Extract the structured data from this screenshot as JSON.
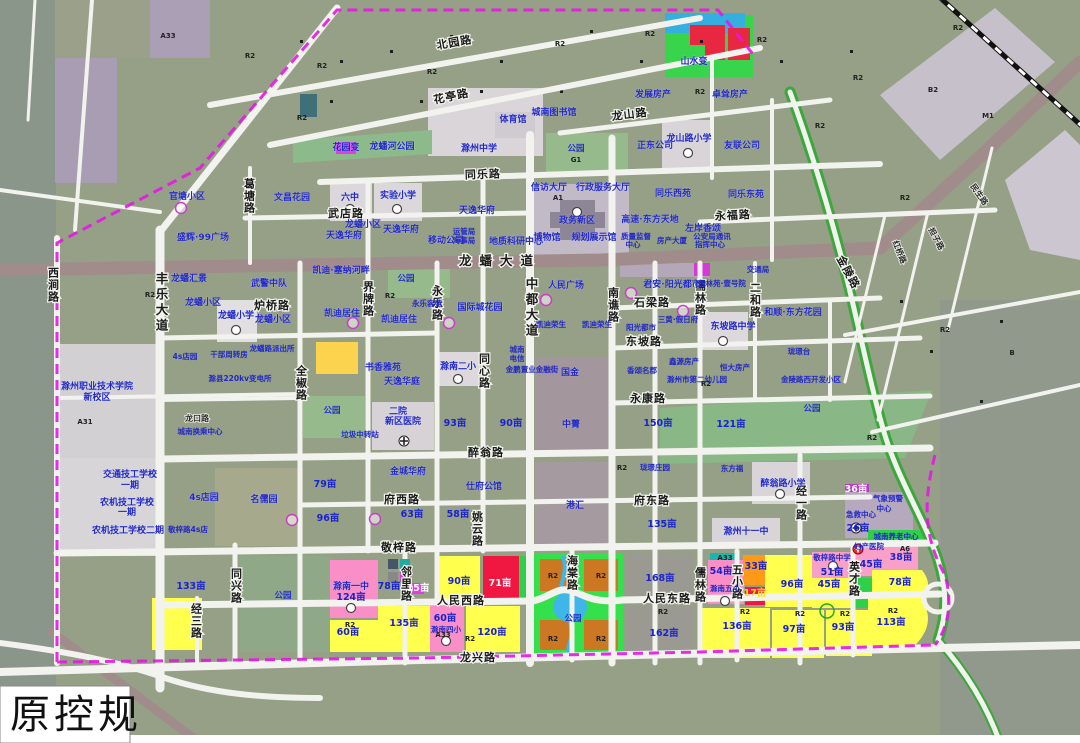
{
  "caption": "原控规",
  "colors": {
    "parcel_base": "#95a086",
    "residential_existing": "#9aa18c",
    "proposed_residential_yellow": "#ffff33",
    "school_pink": "#f98fc6",
    "commercial_red": "#f01840",
    "orange_r2": "#cc7722",
    "orange_parcel": "#ff9a18",
    "park_green": "#35e04d",
    "water_blue": "#3fb6e8",
    "magenta_utility": "#e838e8",
    "road_white": "#f2f2ee",
    "arterial_mauve": "#a18c8c",
    "boundary_magenta": "#e616e6",
    "label_blue": "#2128c8",
    "light_public": "#d9d5d9",
    "lavender_admin": "#c2bbc7"
  },
  "map": {
    "road_labels": [
      {
        "t": "北园路",
        "x": 455,
        "y": 46,
        "r": -10
      },
      {
        "t": "花亭路",
        "x": 452,
        "y": 100,
        "r": -12
      },
      {
        "t": "龙山路",
        "x": 630,
        "y": 118,
        "r": -7
      },
      {
        "t": "同乐路",
        "x": 483,
        "y": 178,
        "r": -2
      },
      {
        "t": "武店路",
        "x": 346,
        "y": 217
      },
      {
        "t": "永福路",
        "x": 733,
        "y": 219,
        "r": -3
      },
      {
        "t": "龙蟠大道",
        "x": 500,
        "y": 265,
        "s": "lg"
      },
      {
        "t": "炉桥路",
        "x": 272,
        "y": 309
      },
      {
        "t": "石梁路",
        "x": 652,
        "y": 306
      },
      {
        "t": "东坡路",
        "x": 644,
        "y": 345
      },
      {
        "t": "永康路",
        "x": 648,
        "y": 402
      },
      {
        "t": "醉翁路",
        "x": 486,
        "y": 456
      },
      {
        "t": "府西路",
        "x": 402,
        "y": 503
      },
      {
        "t": "府东路",
        "x": 652,
        "y": 504
      },
      {
        "t": "敬梓路",
        "x": 399,
        "y": 551
      },
      {
        "t": "人民西路",
        "x": 461,
        "y": 604
      },
      {
        "t": "人民东路",
        "x": 667,
        "y": 602
      },
      {
        "t": "龙兴路",
        "x": 478,
        "y": 661
      },
      {
        "t": "龙口路",
        "x": 197,
        "y": 421,
        "s": "sm"
      },
      {
        "t": "西涧路",
        "x": 53,
        "y": 285,
        "v": 1
      },
      {
        "t": "丰乐大道",
        "x": 161,
        "y": 303,
        "v": 1,
        "s": "lg"
      },
      {
        "t": "葛塘路",
        "x": 249,
        "y": 196,
        "v": 1
      },
      {
        "t": "全椒路",
        "x": 301,
        "y": 383,
        "v": 1
      },
      {
        "t": "同兴路",
        "x": 236,
        "y": 586,
        "v": 1
      },
      {
        "t": "经三路",
        "x": 196,
        "y": 621,
        "v": 1
      },
      {
        "t": "界牌路",
        "x": 368,
        "y": 299,
        "v": 1
      },
      {
        "t": "永乐路",
        "x": 437,
        "y": 303,
        "v": 1
      },
      {
        "t": "中都大道",
        "x": 531,
        "y": 308,
        "v": 1,
        "s": "lg"
      },
      {
        "t": "南谯路",
        "x": 613,
        "y": 305,
        "v": 1
      },
      {
        "t": "同心路",
        "x": 484,
        "y": 371,
        "v": 1
      },
      {
        "t": "姚云路",
        "x": 477,
        "y": 529,
        "v": 1
      },
      {
        "t": "邻里路",
        "x": 406,
        "y": 584,
        "v": 1
      },
      {
        "t": "海棠路",
        "x": 572,
        "y": 573,
        "v": 1
      },
      {
        "t": "儒林路",
        "x": 700,
        "y": 298,
        "v": 1
      },
      {
        "t": "儒林路",
        "x": 700,
        "y": 585,
        "v": 1
      },
      {
        "t": "二和路",
        "x": 755,
        "y": 300,
        "v": 1
      },
      {
        "t": "经一路",
        "x": 801,
        "y": 503,
        "v": 1
      },
      {
        "t": "英才路",
        "x": 854,
        "y": 579,
        "v": 1
      },
      {
        "t": "五小路",
        "x": 737,
        "y": 582,
        "v": 1
      },
      {
        "t": "金陵路",
        "x": 845,
        "y": 274,
        "r": 62
      },
      {
        "t": "红桥路",
        "x": 897,
        "y": 253,
        "r": 68,
        "s": "sm"
      },
      {
        "t": "担子路",
        "x": 934,
        "y": 240,
        "r": 62,
        "s": "sm"
      },
      {
        "t": "民生路",
        "x": 977,
        "y": 196,
        "r": 55,
        "s": "sm"
      }
    ],
    "place_labels": [
      {
        "t": "官塘小区",
        "x": 187,
        "y": 199
      },
      {
        "t": "文昌花园",
        "x": 292,
        "y": 200
      },
      {
        "t": "盛辉·99广场",
        "x": 203,
        "y": 240
      },
      {
        "t": "龙蟠小区",
        "x": 363,
        "y": 227
      },
      {
        "t": "六中",
        "x": 350,
        "y": 200
      },
      {
        "t": "实验小学",
        "x": 398,
        "y": 198
      },
      {
        "t": "天逸华府",
        "x": 344,
        "y": 238
      },
      {
        "t": "天逸华府",
        "x": 401,
        "y": 232
      },
      {
        "t": "天逸华府",
        "x": 477,
        "y": 213
      },
      {
        "t": "移动公司",
        "x": 446,
        "y": 243
      },
      {
        "t": "运管局",
        "x": 464,
        "y": 234,
        "sm": 1
      },
      {
        "t": "海事局",
        "x": 464,
        "y": 243,
        "sm": 1
      },
      {
        "t": "地质科研中心",
        "x": 516,
        "y": 244
      },
      {
        "t": "信访大厅",
        "x": 549,
        "y": 190
      },
      {
        "t": "行政服务大厅",
        "x": 603,
        "y": 190
      },
      {
        "t": "政务新区",
        "x": 577,
        "y": 223
      },
      {
        "t": "博物馆",
        "x": 547,
        "y": 240
      },
      {
        "t": "规划展示馆",
        "x": 594,
        "y": 240
      },
      {
        "t": "质量监督",
        "x": 636,
        "y": 239,
        "sm": 1
      },
      {
        "t": "中心",
        "x": 633,
        "y": 247,
        "sm": 1
      },
      {
        "t": "房产大厦",
        "x": 672,
        "y": 243,
        "sm": 1
      },
      {
        "t": "公安局通讯",
        "x": 712,
        "y": 239,
        "sm": 1
      },
      {
        "t": "指挥中心",
        "x": 710,
        "y": 247,
        "sm": 1
      },
      {
        "t": "高速·东方天地",
        "x": 650,
        "y": 222
      },
      {
        "t": "同乐西苑",
        "x": 673,
        "y": 196
      },
      {
        "t": "同乐东苑",
        "x": 746,
        "y": 197
      },
      {
        "t": "左岸香颂",
        "x": 703,
        "y": 231
      },
      {
        "t": "正东公司",
        "x": 655,
        "y": 148
      },
      {
        "t": "友联公司",
        "x": 742,
        "y": 148
      },
      {
        "t": "龙山路小学",
        "x": 689,
        "y": 141
      },
      {
        "t": "发展房产",
        "x": 653,
        "y": 97
      },
      {
        "t": "卓耸房产",
        "x": 730,
        "y": 97
      },
      {
        "t": "山水变",
        "x": 694,
        "y": 64
      },
      {
        "t": "城南图书馆",
        "x": 554,
        "y": 115
      },
      {
        "t": "体育馆",
        "x": 513,
        "y": 122
      },
      {
        "t": "滁州中学",
        "x": 479,
        "y": 151
      },
      {
        "t": "花园变",
        "x": 346,
        "y": 150
      },
      {
        "t": "龙蟠河公园",
        "x": 392,
        "y": 149
      },
      {
        "t": "凯迪·塞纳河畔",
        "x": 341,
        "y": 273
      },
      {
        "t": "龙蟠汇景",
        "x": 189,
        "y": 281
      },
      {
        "t": "武警中队",
        "x": 269,
        "y": 286
      },
      {
        "t": "龙蟠小区",
        "x": 203,
        "y": 305
      },
      {
        "t": "龙蟠小学",
        "x": 236,
        "y": 318
      },
      {
        "t": "龙蟠小区",
        "x": 273,
        "y": 322
      },
      {
        "t": "凯迪居住",
        "x": 342,
        "y": 316
      },
      {
        "t": "凯迪居住",
        "x": 399,
        "y": 322
      },
      {
        "t": "永乐容苑",
        "x": 427,
        "y": 306,
        "sm": 1
      },
      {
        "t": "国际城花园",
        "x": 480,
        "y": 310
      },
      {
        "t": "凯迪荣生",
        "x": 551,
        "y": 327,
        "sm": 1
      },
      {
        "t": "凯迪荣生",
        "x": 597,
        "y": 327,
        "sm": 1
      },
      {
        "t": "人民广场",
        "x": 566,
        "y": 288
      },
      {
        "t": "君安·阳光都市",
        "x": 672,
        "y": 287
      },
      {
        "t": "儒林苑·壹号院",
        "x": 722,
        "y": 286,
        "sm": 1
      },
      {
        "t": "交通局",
        "x": 758,
        "y": 272,
        "sm": 1
      },
      {
        "t": "三黄·假日府",
        "x": 678,
        "y": 322,
        "sm": 1
      },
      {
        "t": "阳光都市",
        "x": 641,
        "y": 330,
        "sm": 1
      },
      {
        "t": "东坡路中学",
        "x": 733,
        "y": 329
      },
      {
        "t": "和顺·东方花园",
        "x": 793,
        "y": 315
      },
      {
        "t": "香颂名郡",
        "x": 642,
        "y": 373,
        "sm": 1
      },
      {
        "t": "鑫源房产",
        "x": 684,
        "y": 364,
        "sm": 1
      },
      {
        "t": "恒大房产",
        "x": 735,
        "y": 370,
        "sm": 1
      },
      {
        "t": "滁州市第二幼儿园",
        "x": 697,
        "y": 382,
        "sm": 1
      },
      {
        "t": "珑璟台",
        "x": 799,
        "y": 354,
        "sm": 1
      },
      {
        "t": "金陵路西开发小区",
        "x": 811,
        "y": 382,
        "sm": 1
      },
      {
        "t": "书香雅苑",
        "x": 383,
        "y": 370
      },
      {
        "t": "滁南二小",
        "x": 458,
        "y": 369
      },
      {
        "t": "城南",
        "x": 517,
        "y": 352,
        "sm": 1
      },
      {
        "t": "电信",
        "x": 517,
        "y": 361,
        "sm": 1
      },
      {
        "t": "金鹏置业金融街",
        "x": 532,
        "y": 372,
        "sm": 1
      },
      {
        "t": "国金",
        "x": 570,
        "y": 375
      },
      {
        "t": "中菁",
        "x": 571,
        "y": 427
      },
      {
        "t": "天逸华庭",
        "x": 402,
        "y": 384
      },
      {
        "t": "二院",
        "x": 398,
        "y": 414
      },
      {
        "t": "新区医院",
        "x": 403,
        "y": 424
      },
      {
        "t": "垃圾中转站",
        "x": 360,
        "y": 437,
        "sm": 1
      },
      {
        "t": "金城华府",
        "x": 408,
        "y": 474
      },
      {
        "t": "仕府公馆",
        "x": 484,
        "y": 489
      },
      {
        "t": "港汇",
        "x": 575,
        "y": 508
      },
      {
        "t": "珑璟庄园",
        "x": 655,
        "y": 470,
        "sm": 1
      },
      {
        "t": "东方福",
        "x": 732,
        "y": 471,
        "sm": 1
      },
      {
        "t": "醉翁路小学",
        "x": 783,
        "y": 486
      },
      {
        "t": "滁州十一中",
        "x": 746,
        "y": 534
      },
      {
        "t": "气象预警",
        "x": 888,
        "y": 501,
        "sm": 1
      },
      {
        "t": "中心",
        "x": 884,
        "y": 511,
        "sm": 1
      },
      {
        "t": "急救中心",
        "x": 861,
        "y": 517,
        "sm": 1
      },
      {
        "t": "城南养老中心",
        "x": 896,
        "y": 539,
        "sm": 1
      },
      {
        "t": "妇产医院",
        "x": 869,
        "y": 549,
        "sm": 1
      },
      {
        "t": "敬梓路中学",
        "x": 832,
        "y": 560,
        "sm": 1
      },
      {
        "t": "滁南五小",
        "x": 725,
        "y": 591,
        "sm": 1
      },
      {
        "t": "滁南一中",
        "x": 351,
        "y": 589
      },
      {
        "t": "滁南四小",
        "x": 446,
        "y": 632,
        "sm": 1
      },
      {
        "t": "交通技工学校",
        "x": 130,
        "y": 477
      },
      {
        "t": "一期",
        "x": 130,
        "y": 488
      },
      {
        "t": "农机技工学校",
        "x": 127,
        "y": 505
      },
      {
        "t": "一期",
        "x": 127,
        "y": 515
      },
      {
        "t": "农机技工学校二期",
        "x": 128,
        "y": 533
      },
      {
        "t": "名儒园",
        "x": 264,
        "y": 502
      },
      {
        "t": "4s店园",
        "x": 185,
        "y": 359,
        "sm": 1
      },
      {
        "t": "4s店园",
        "x": 204,
        "y": 500
      },
      {
        "t": "干部周转房",
        "x": 229,
        "y": 357,
        "sm": 1
      },
      {
        "t": "龙蟠路派出所",
        "x": 272,
        "y": 351,
        "sm": 1
      },
      {
        "t": "滁县220kv变电所",
        "x": 240,
        "y": 381,
        "sm": 1
      },
      {
        "t": "滁州职业技术学院",
        "x": 97,
        "y": 389
      },
      {
        "t": "新校区",
        "x": 97,
        "y": 400
      },
      {
        "t": "城南换乘中心",
        "x": 200,
        "y": 434,
        "sm": 1
      },
      {
        "t": "敬梓路4s店",
        "x": 188,
        "y": 532,
        "sm": 1
      }
    ],
    "park_labels": [
      {
        "t": "公园",
        "x": 406,
        "y": 281
      },
      {
        "t": "公园",
        "x": 332,
        "y": 413
      },
      {
        "t": "公园",
        "x": 283,
        "y": 598
      },
      {
        "t": "公园",
        "x": 576,
        "y": 151
      },
      {
        "t": "公园",
        "x": 812,
        "y": 411
      },
      {
        "t": "公园",
        "x": 573,
        "y": 621
      }
    ],
    "area_labels": [
      {
        "t": "133亩",
        "x": 191,
        "y": 589
      },
      {
        "t": "79亩",
        "x": 325,
        "y": 487
      },
      {
        "t": "96亩",
        "x": 328,
        "y": 521
      },
      {
        "t": "63亩",
        "x": 412,
        "y": 517
      },
      {
        "t": "58亩",
        "x": 458,
        "y": 517
      },
      {
        "t": "93亩",
        "x": 455,
        "y": 426
      },
      {
        "t": "90亩",
        "x": 511,
        "y": 426
      },
      {
        "t": "150亩",
        "x": 658,
        "y": 426
      },
      {
        "t": "121亩",
        "x": 731,
        "y": 427
      },
      {
        "t": "135亩",
        "x": 662,
        "y": 527
      },
      {
        "t": "78亩",
        "x": 389,
        "y": 589
      },
      {
        "t": "15亩",
        "x": 418,
        "y": 591,
        "f": "w"
      },
      {
        "t": "124亩",
        "x": 351,
        "y": 600
      },
      {
        "t": "60亩",
        "x": 348,
        "y": 635
      },
      {
        "t": "135亩",
        "x": 404,
        "y": 626
      },
      {
        "t": "90亩",
        "x": 459,
        "y": 584
      },
      {
        "t": "71亩",
        "x": 500,
        "y": 586,
        "f": "w"
      },
      {
        "t": "60亩",
        "x": 445,
        "y": 621
      },
      {
        "t": "120亩",
        "x": 492,
        "y": 635
      },
      {
        "t": "168亩",
        "x": 660,
        "y": 581
      },
      {
        "t": "162亩",
        "x": 664,
        "y": 636
      },
      {
        "t": "54亩",
        "x": 721,
        "y": 574
      },
      {
        "t": "33亩",
        "x": 756,
        "y": 569
      },
      {
        "t": "17亩",
        "x": 755,
        "y": 596,
        "f": "y"
      },
      {
        "t": "96亩",
        "x": 792,
        "y": 587
      },
      {
        "t": "51亩",
        "x": 832,
        "y": 575
      },
      {
        "t": "45亩",
        "x": 871,
        "y": 567
      },
      {
        "t": "38亩",
        "x": 901,
        "y": 560
      },
      {
        "t": "45亩",
        "x": 829,
        "y": 587
      },
      {
        "t": "78亩",
        "x": 900,
        "y": 585
      },
      {
        "t": "136亩",
        "x": 737,
        "y": 629
      },
      {
        "t": "97亩",
        "x": 794,
        "y": 632
      },
      {
        "t": "93亩",
        "x": 843,
        "y": 630
      },
      {
        "t": "113亩",
        "x": 891,
        "y": 625
      },
      {
        "t": "36亩",
        "x": 856,
        "y": 492,
        "f": "w"
      },
      {
        "t": "26亩",
        "x": 858,
        "y": 531
      }
    ],
    "zone_codes": [
      {
        "t": "A33",
        "x": 168,
        "y": 38
      },
      {
        "t": "R2",
        "x": 250,
        "y": 58
      },
      {
        "t": "R2",
        "x": 322,
        "y": 68
      },
      {
        "t": "R2",
        "x": 432,
        "y": 74
      },
      {
        "t": "R2",
        "x": 560,
        "y": 46
      },
      {
        "t": "R2",
        "x": 650,
        "y": 36
      },
      {
        "t": "R2",
        "x": 762,
        "y": 42
      },
      {
        "t": "R2",
        "x": 858,
        "y": 80
      },
      {
        "t": "R2",
        "x": 958,
        "y": 30
      },
      {
        "t": "R2",
        "x": 302,
        "y": 120
      },
      {
        "t": "R2",
        "x": 700,
        "y": 94
      },
      {
        "t": "R2",
        "x": 820,
        "y": 128
      },
      {
        "t": "B2",
        "x": 933,
        "y": 92
      },
      {
        "t": "M1",
        "x": 988,
        "y": 118
      },
      {
        "t": "B",
        "x": 1012,
        "y": 355
      },
      {
        "t": "R2",
        "x": 905,
        "y": 200
      },
      {
        "t": "R2",
        "x": 945,
        "y": 332
      },
      {
        "t": "R2",
        "x": 872,
        "y": 440
      },
      {
        "t": "R2",
        "x": 150,
        "y": 297
      },
      {
        "t": "R2",
        "x": 390,
        "y": 298
      },
      {
        "t": "R2",
        "x": 622,
        "y": 470
      },
      {
        "t": "R2",
        "x": 706,
        "y": 386
      },
      {
        "t": "A31",
        "x": 85,
        "y": 424
      },
      {
        "t": "A1",
        "x": 558,
        "y": 200
      },
      {
        "t": "G1",
        "x": 576,
        "y": 162
      },
      {
        "t": "R2",
        "x": 553,
        "y": 578
      },
      {
        "t": "R2",
        "x": 601,
        "y": 578
      },
      {
        "t": "R2",
        "x": 553,
        "y": 641
      },
      {
        "t": "R2",
        "x": 601,
        "y": 641
      },
      {
        "t": "R2",
        "x": 350,
        "y": 627
      },
      {
        "t": "R2",
        "x": 470,
        "y": 641
      },
      {
        "t": "A33",
        "x": 443,
        "y": 637
      },
      {
        "t": "R2",
        "x": 663,
        "y": 614
      },
      {
        "t": "R2",
        "x": 745,
        "y": 614
      },
      {
        "t": "R2",
        "x": 800,
        "y": 616
      },
      {
        "t": "R2",
        "x": 845,
        "y": 616
      },
      {
        "t": "R2",
        "x": 893,
        "y": 613
      },
      {
        "t": "A6",
        "x": 905,
        "y": 551
      },
      {
        "t": "A33",
        "x": 725,
        "y": 560
      }
    ]
  }
}
